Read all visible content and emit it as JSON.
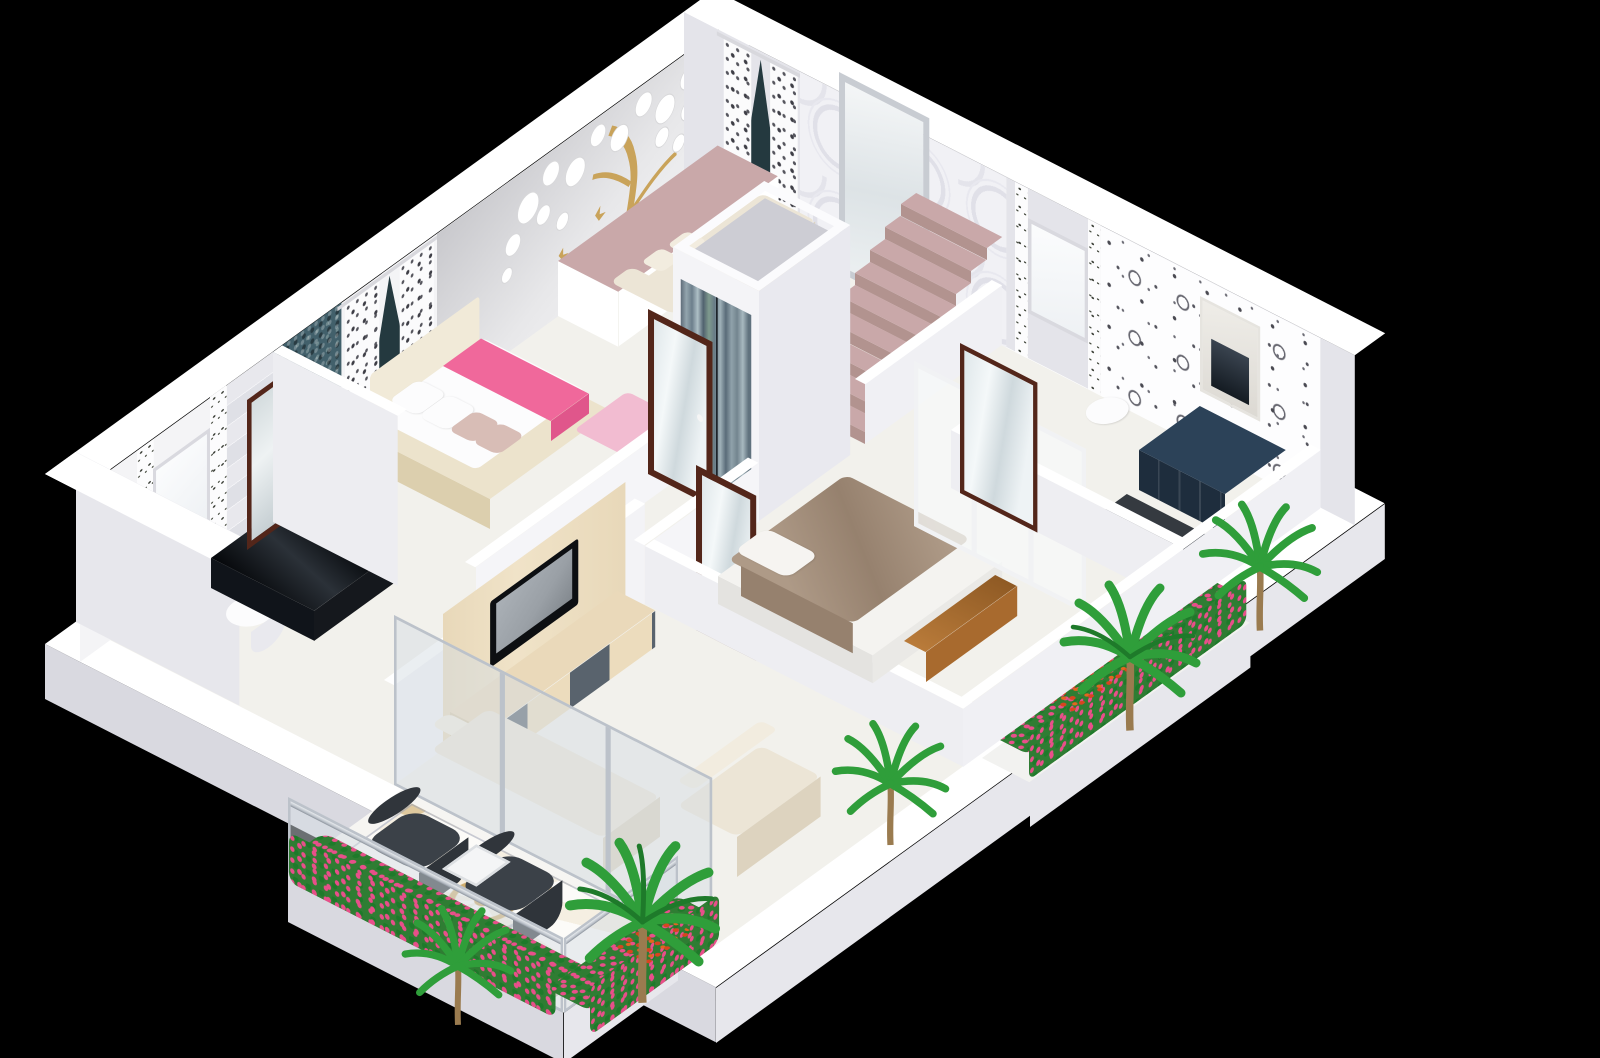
{
  "scene": {
    "title": "3D isometric cutaway floor plan render of an apartment on a black background",
    "background": "#000000"
  },
  "palette": {
    "bg": "#000000",
    "wall": "#f4f4f6",
    "wallShade": "#e7e7ec",
    "wallDark": "#d9d9e0",
    "plinth": "#ffffff",
    "floor": "#f2f1ec",
    "teal": "#42606b",
    "tealCurtain": "#24393f",
    "mauve": "#c9a8a9",
    "mauveDark": "#b2938f",
    "pink": "#f0689b",
    "pinkDark": "#e0568b",
    "pinkLight": "#f2bcd1",
    "blush": "#d8bdb6",
    "cream": "#ece5d6",
    "creamDark": "#ddd3bf",
    "bedframe": "#ece3cc",
    "bedframeDark": "#dccfae",
    "headboard": "#f1ead8",
    "wood": "#53261a",
    "woodLight": "#e8d8b9",
    "charcoal": "#3b4148",
    "charcoalDark": "#30353b",
    "taupe": "#ae9a87",
    "taupeDark": "#96816e",
    "navy": "#1e2d3d",
    "navyTop": "#2c4258",
    "black": "#10141a",
    "gold": "#c9a35a",
    "green": "#2f9e3a",
    "greenDark": "#1e7a2a",
    "trunk": "#9a7b4f",
    "flowerPink": "#e84f8a",
    "flowerRed": "#d8451f",
    "chrome": "#bcc2ca",
    "glass": "rgba(213,222,228,0.5)",
    "glassWhite": "rgba(247,249,250,0.72)",
    "mirror": "#e9eef0",
    "screen": "#9aa0a6",
    "metalSeam": "#1c232a"
  },
  "inventory": {
    "rooms": [
      {
        "name": "bathroom-left",
        "items": [
          "toilet",
          "black-gloss-counter",
          "wood-framed-mirror",
          "window",
          "vine-wallpaper-strips",
          "gray-tile-band"
        ]
      },
      {
        "name": "master-bedroom",
        "items": [
          "double-bed",
          "white-pillows",
          "blush-pillows",
          "pink-runner",
          "pink-rug",
          "patterned-curtains",
          "teal-mosaic-panel",
          "white-flower-mural-with-gold-tree",
          "open-mirror-door"
        ]
      },
      {
        "name": "lounge-platform",
        "items": [
          "cream-sofa",
          "cushions",
          "white-coffee-table",
          "white-side-table",
          "teal-curtain-window",
          "mauve-platform"
        ]
      },
      {
        "name": "stairwell",
        "items": [
          "staircase",
          "circle-relief-feature-wall",
          "silver-framed-mirror",
          "elevator-with-metallic-doors"
        ]
      },
      {
        "name": "hallway",
        "items": [
          "open-mirror-door"
        ]
      },
      {
        "name": "living-room",
        "items": [
          "tv-wall-unit",
          "television",
          "checkered-tv-cabinet",
          "l-shaped-cream-sofa",
          "sliding-glass-doors"
        ]
      },
      {
        "name": "balcony",
        "items": [
          "charcoal-armchair",
          "charcoal-armchair",
          "glass-coffee-table",
          "ornate-tile-medallion-floor",
          "glass-balustrade-with-chrome-rail",
          "flower-planters"
        ]
      },
      {
        "name": "bedroom-2",
        "items": [
          "double-bed-taupe-blanket",
          "white-pillow",
          "wood-bench",
          "white-glass-partition"
        ]
      },
      {
        "name": "bathroom-right",
        "items": [
          "navy-vanity",
          "marble-niche",
          "floral-wallpaper",
          "wood-framed-shower-door",
          "toilet",
          "window"
        ]
      }
    ],
    "stairs_steps": 9,
    "plants": {
      "palm_count": 5,
      "hedge_flower_colors": [
        "pink",
        "red-orange"
      ]
    }
  }
}
